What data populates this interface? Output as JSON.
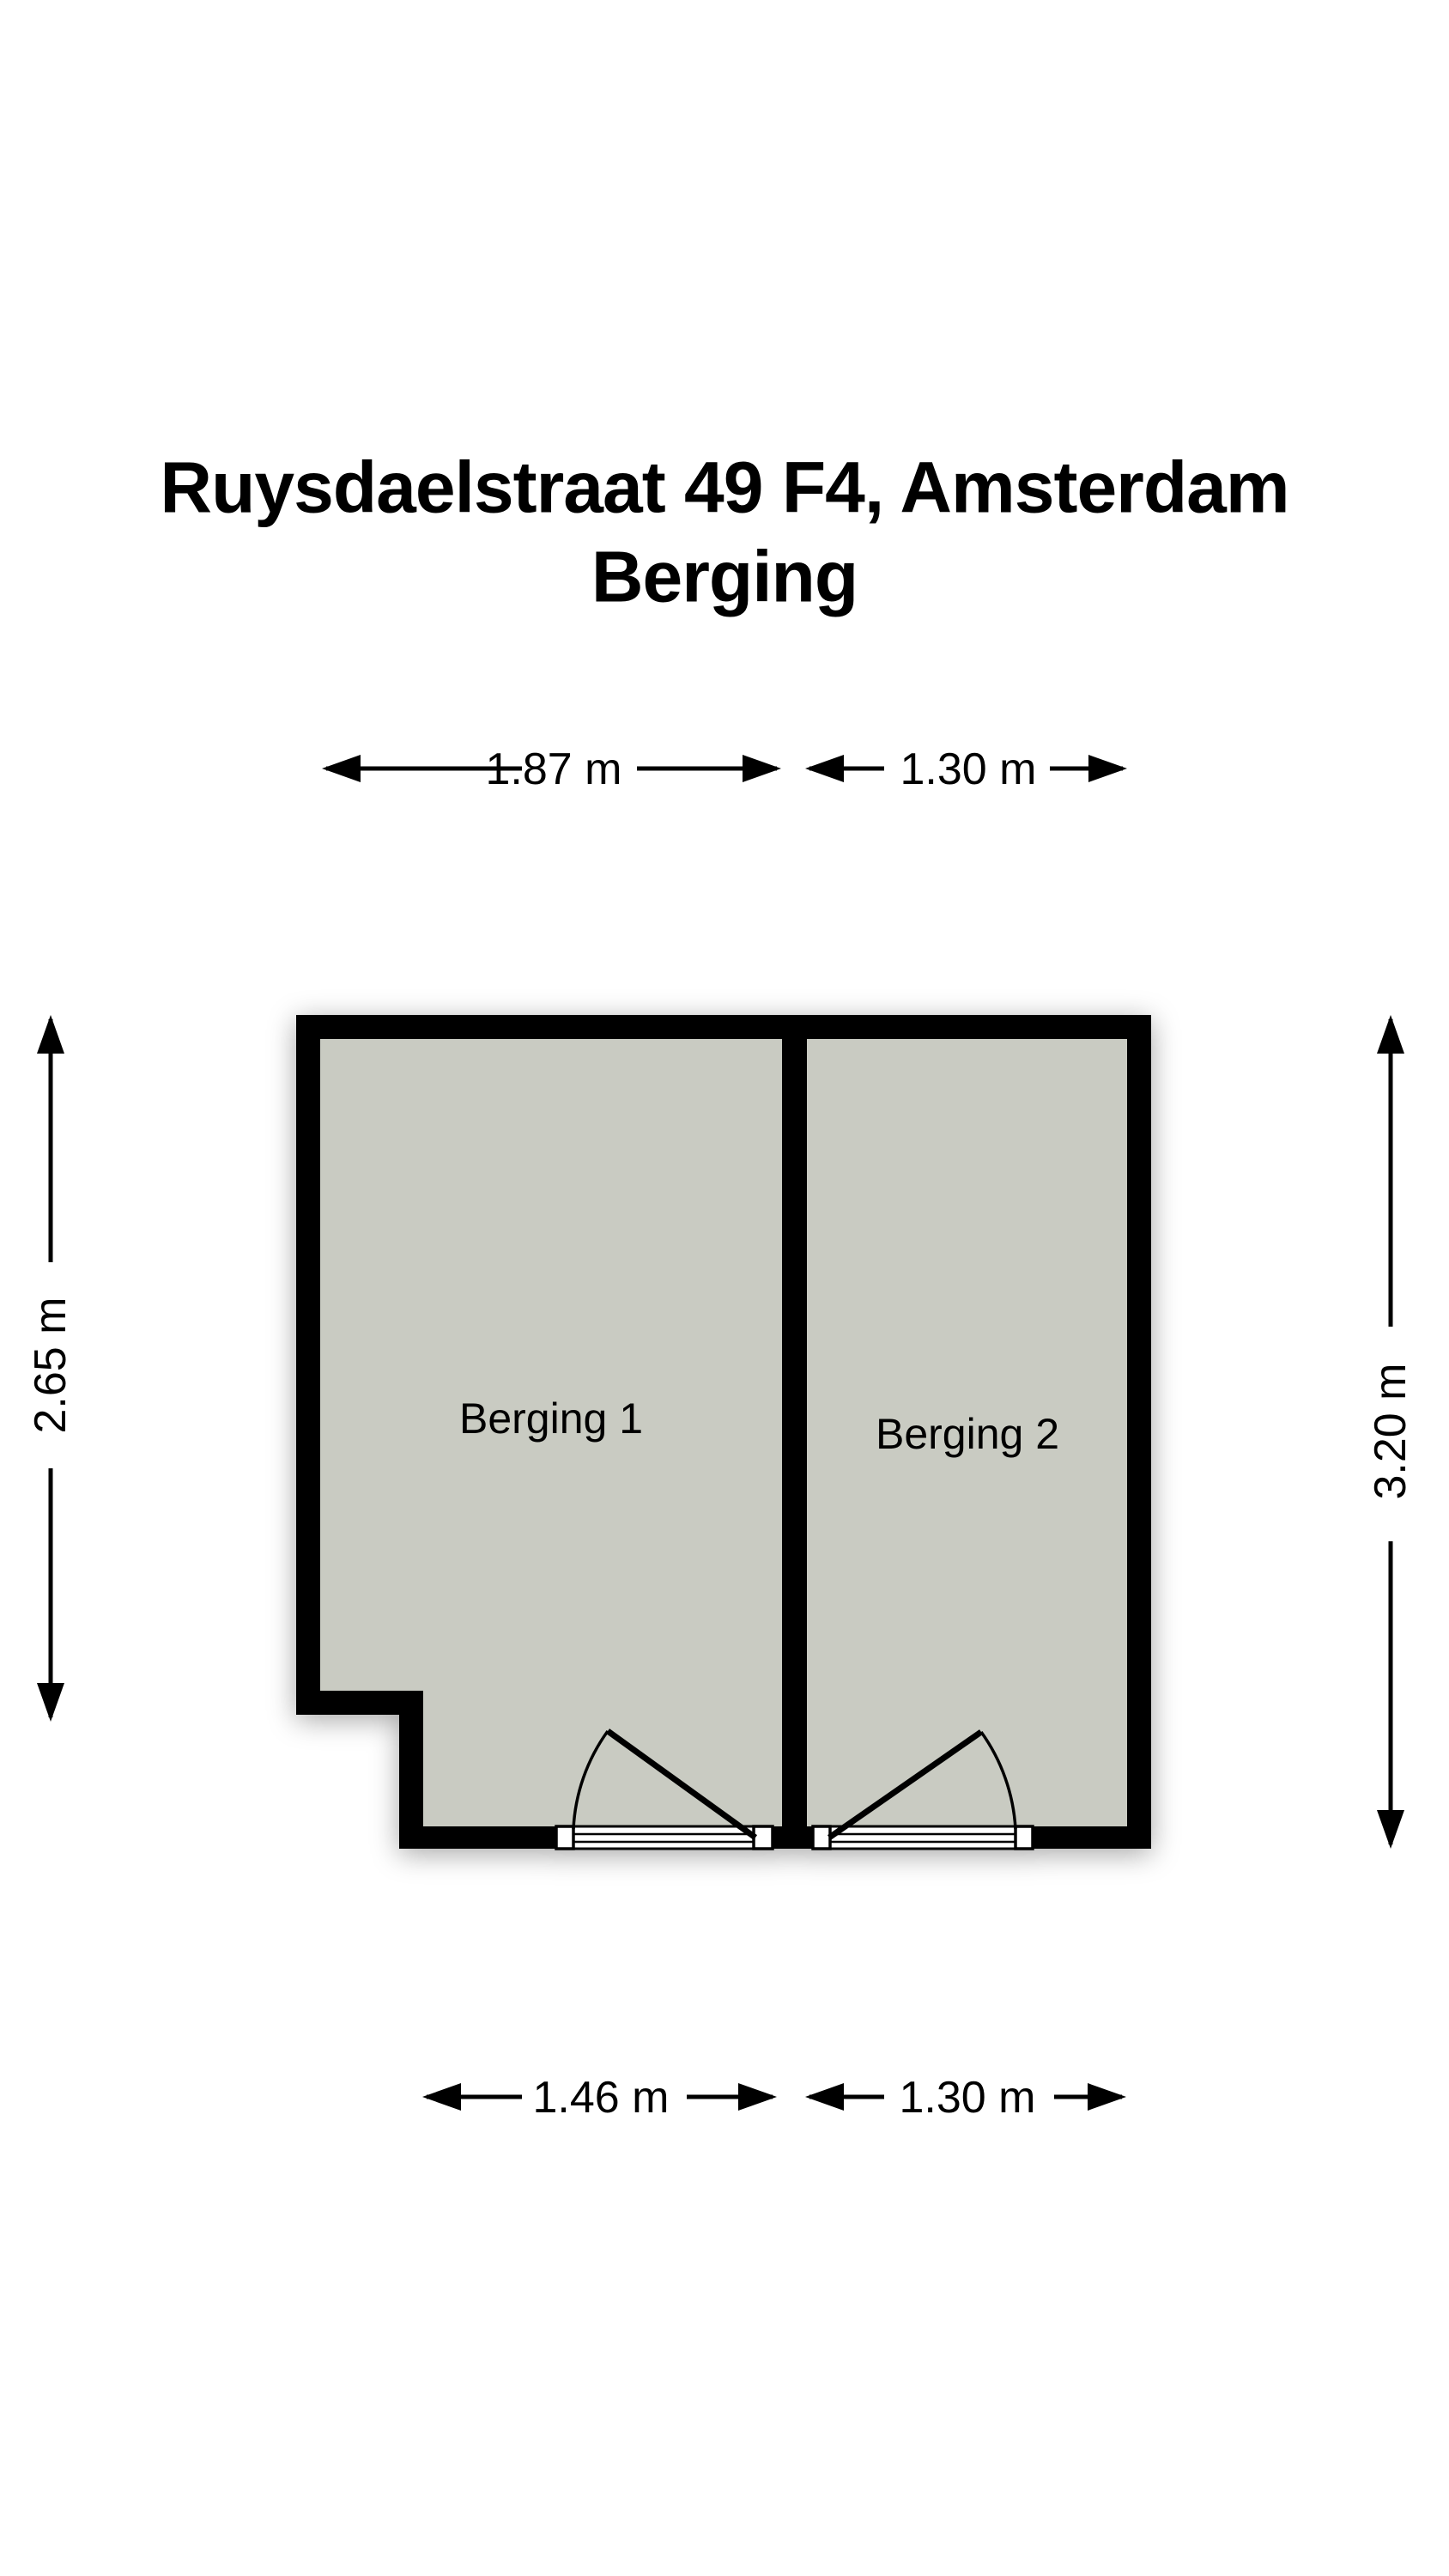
{
  "title": {
    "line1": "Ruysdaelstraat 49 F4, Amsterdam",
    "line2": "Berging"
  },
  "rooms": [
    {
      "label": "Berging 1"
    },
    {
      "label": "Berging 2"
    }
  ],
  "dimensions": {
    "top_left": "1.87 m",
    "top_right": "1.30 m",
    "bottom_left": "1.46 m",
    "bottom_right": "1.30 m",
    "left_side": "2.65 m",
    "right_side": "3.20 m"
  },
  "colors": {
    "wall": "#000000",
    "floor": "#c9cbc2",
    "door_fill": "#ffffff",
    "background": "#ffffff",
    "text": "#000000"
  }
}
